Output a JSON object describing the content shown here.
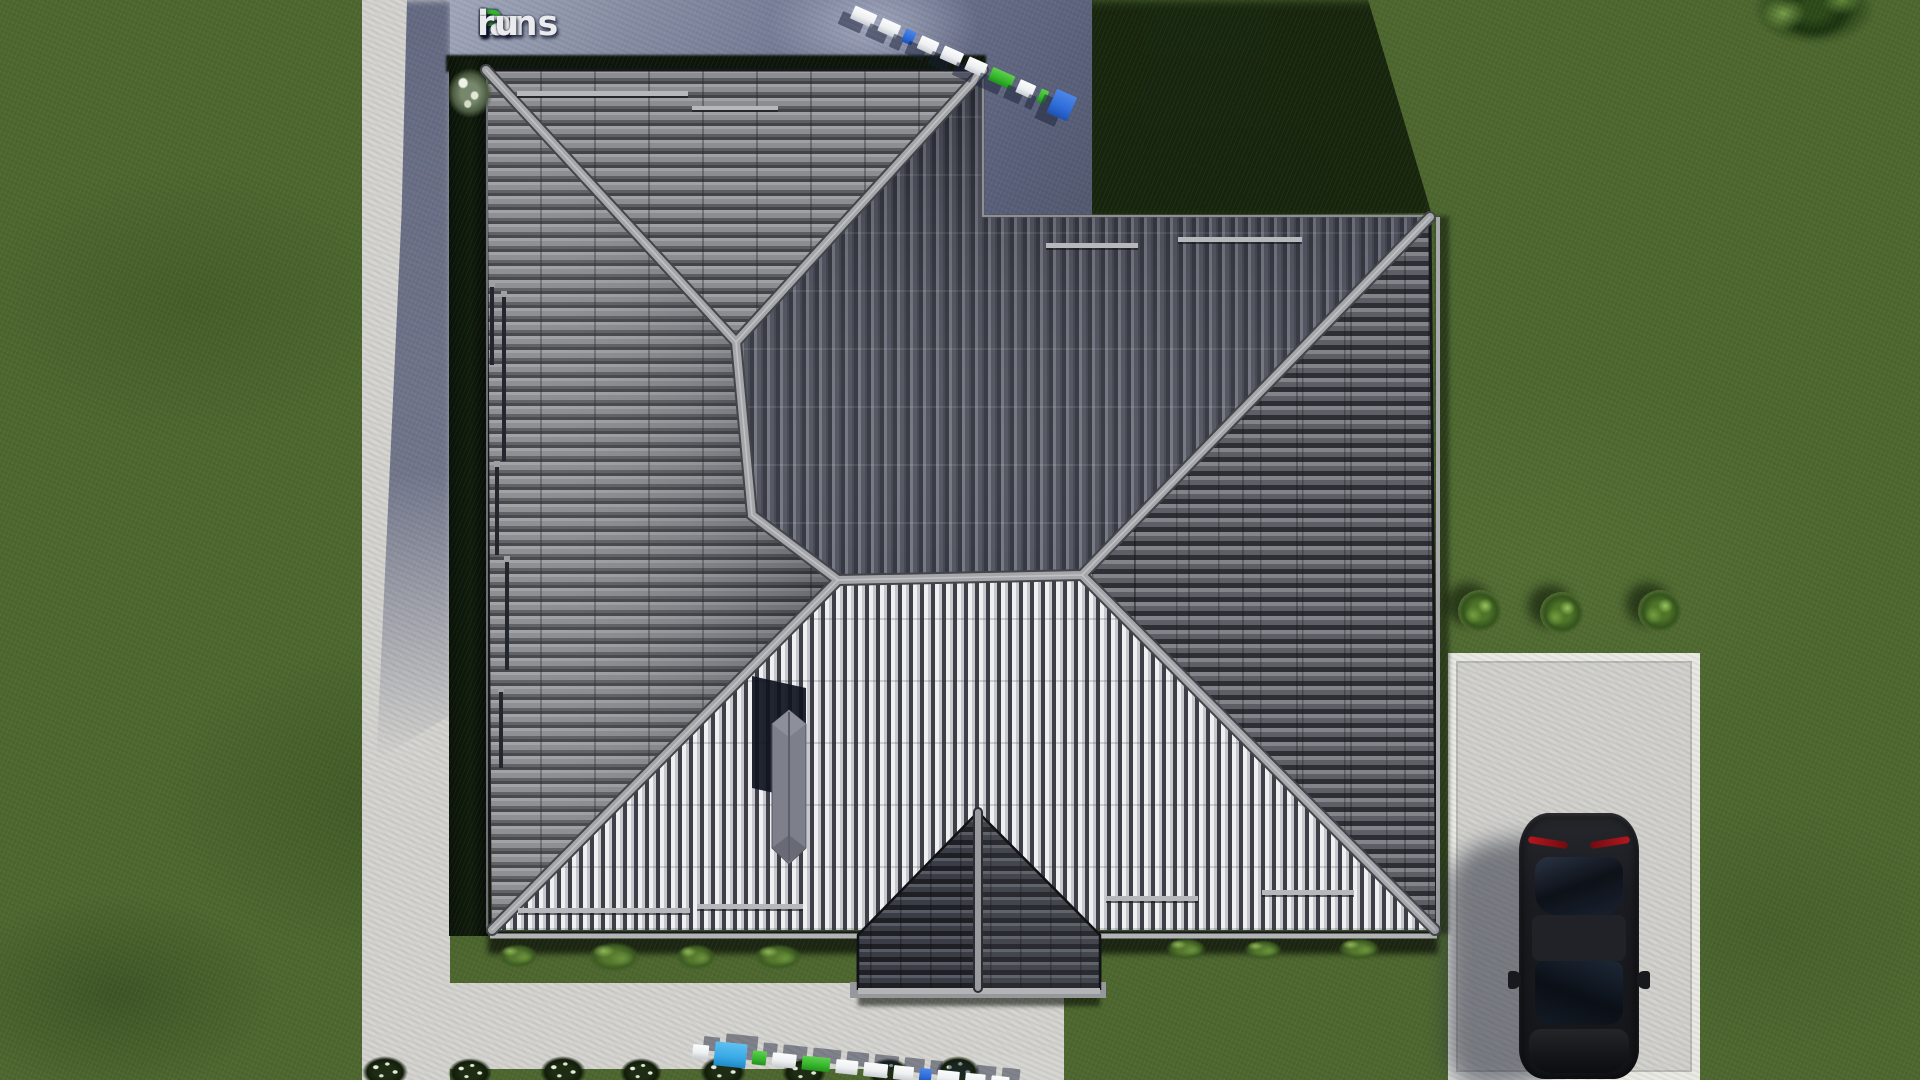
{
  "watermark": {
    "full_text": "FixPlans.ru",
    "parts": {
      "f": "F",
      "ix": "ix",
      "p": "P",
      "lans": "lans",
      "dot": ".",
      "ru": "ru"
    }
  },
  "colors": {
    "grass": "#4d672f",
    "grass_shadow": "#121f0b",
    "concrete": "#d6d5d2",
    "concrete_shadow": "#767c96",
    "platform_light": "#9aa0b5",
    "hedge": "#0d150a",
    "driveway": "#d3d2cf",
    "roof_light": "#eff0f2",
    "roof_mid": "#86878c",
    "roof_dark": "#3c3f4a",
    "roof_east": "#5e5f66",
    "roof_porch": "#3a3d45",
    "ridge": "#a6a7ab",
    "accent_blue": "#2e6cd8",
    "accent_green": "#35b52c",
    "accent_lightblue": "#38a9e6",
    "segment_white": "#eef0f2",
    "segment_shadow": "#182038",
    "car_body": "#1a1c21",
    "car_glass": "#0d1118",
    "taillight": "#b5171d"
  },
  "scale_bars": {
    "top": [
      "white",
      "white",
      "blue",
      "white",
      "white",
      "white",
      "green",
      "white",
      "green",
      "blue_large"
    ],
    "bottom": [
      "white",
      "lightblue_large",
      "green",
      "white",
      "green",
      "white",
      "white",
      "white",
      "blue",
      "white",
      "white",
      "white"
    ]
  }
}
